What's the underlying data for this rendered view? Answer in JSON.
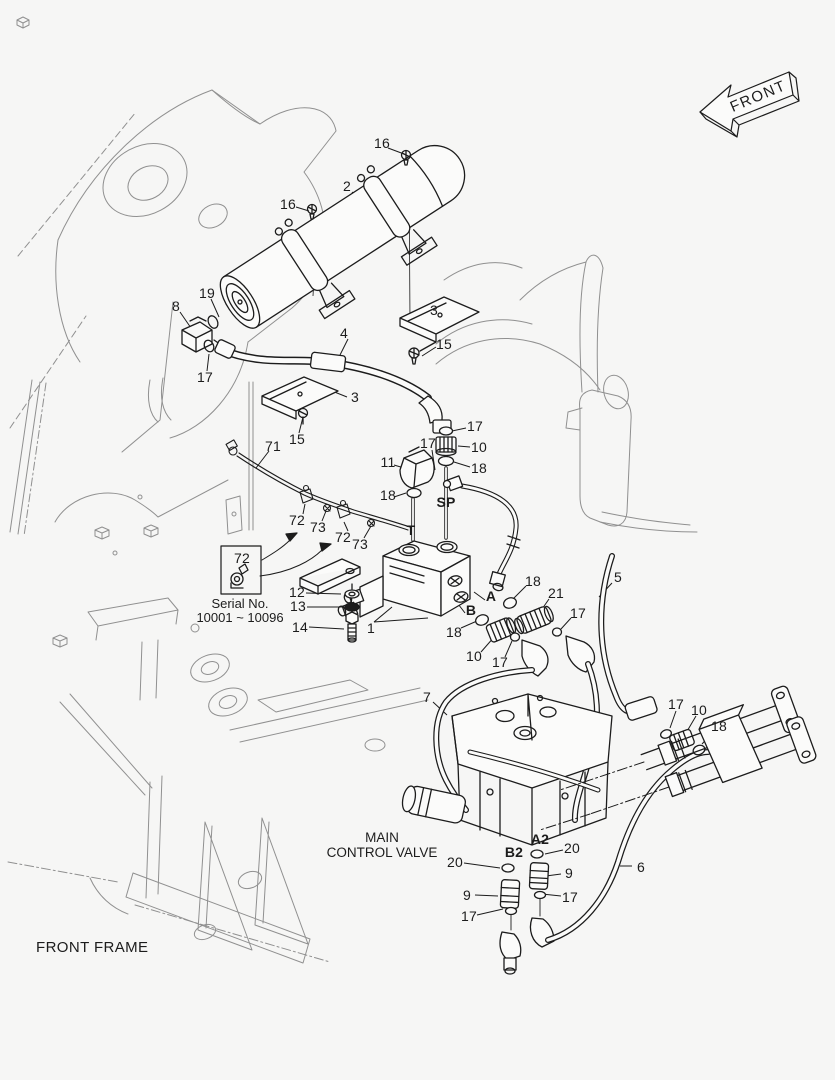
{
  "page": {
    "background": "#f6f6f5",
    "ink": "#1c1c1c",
    "faint": "#909090"
  },
  "front_arrow": {
    "label": "FRONT"
  },
  "frame_caption": {
    "label": "FRONT FRAME"
  },
  "mcv_caption": {
    "line1": "MAIN",
    "line2": "CONTROL VALVE"
  },
  "serial_box": {
    "ref": "72",
    "title": "Serial No.",
    "range": "10001 ~ 10096"
  },
  "callouts": [
    {
      "t": "16",
      "x": 382,
      "y": 143
    },
    {
      "t": "2",
      "x": 347,
      "y": 186
    },
    {
      "t": "16",
      "x": 288,
      "y": 204
    },
    {
      "t": "19",
      "x": 207,
      "y": 293
    },
    {
      "t": "8",
      "x": 176,
      "y": 306
    },
    {
      "t": "3",
      "x": 434,
      "y": 310
    },
    {
      "t": "4",
      "x": 344,
      "y": 333
    },
    {
      "t": "15",
      "x": 444,
      "y": 344
    },
    {
      "t": "17",
      "x": 205,
      "y": 377
    },
    {
      "t": "3",
      "x": 355,
      "y": 397
    },
    {
      "t": "15",
      "x": 297,
      "y": 439
    },
    {
      "t": "71",
      "x": 273,
      "y": 446
    },
    {
      "t": "17",
      "x": 475,
      "y": 426
    },
    {
      "t": "17",
      "x": 428,
      "y": 443
    },
    {
      "t": "10",
      "x": 479,
      "y": 447
    },
    {
      "t": "11",
      "x": 388,
      "y": 462
    },
    {
      "t": "18",
      "x": 479,
      "y": 468
    },
    {
      "t": "18",
      "x": 388,
      "y": 495
    },
    {
      "t": "SP",
      "x": 446,
      "y": 502,
      "b": 1
    },
    {
      "t": "72",
      "x": 297,
      "y": 520
    },
    {
      "t": "73",
      "x": 318,
      "y": 527
    },
    {
      "t": "T",
      "x": 411,
      "y": 530,
      "b": 1
    },
    {
      "t": "72",
      "x": 343,
      "y": 537
    },
    {
      "t": "73",
      "x": 360,
      "y": 544
    },
    {
      "t": "5",
      "x": 618,
      "y": 577
    },
    {
      "t": "18",
      "x": 533,
      "y": 581
    },
    {
      "t": "12",
      "x": 297,
      "y": 592
    },
    {
      "t": "21",
      "x": 556,
      "y": 593
    },
    {
      "t": "A",
      "x": 491,
      "y": 596,
      "b": 1
    },
    {
      "t": "13",
      "x": 298,
      "y": 606
    },
    {
      "t": "B",
      "x": 471,
      "y": 610,
      "b": 1
    },
    {
      "t": "17",
      "x": 578,
      "y": 613
    },
    {
      "t": "14",
      "x": 300,
      "y": 627
    },
    {
      "t": "1",
      "x": 371,
      "y": 628
    },
    {
      "t": "18",
      "x": 454,
      "y": 632
    },
    {
      "t": "10",
      "x": 474,
      "y": 656
    },
    {
      "t": "17",
      "x": 500,
      "y": 662
    },
    {
      "t": "7",
      "x": 427,
      "y": 697
    },
    {
      "t": "17",
      "x": 676,
      "y": 704
    },
    {
      "t": "10",
      "x": 699,
      "y": 710
    },
    {
      "t": "18",
      "x": 719,
      "y": 726
    },
    {
      "t": "A2",
      "x": 540,
      "y": 839,
      "b": 1
    },
    {
      "t": "20",
      "x": 572,
      "y": 848
    },
    {
      "t": "B2",
      "x": 514,
      "y": 852,
      "b": 1
    },
    {
      "t": "20",
      "x": 455,
      "y": 862
    },
    {
      "t": "6",
      "x": 641,
      "y": 867
    },
    {
      "t": "9",
      "x": 569,
      "y": 873
    },
    {
      "t": "9",
      "x": 467,
      "y": 895
    },
    {
      "t": "17",
      "x": 570,
      "y": 897
    },
    {
      "t": "17",
      "x": 469,
      "y": 916
    }
  ]
}
